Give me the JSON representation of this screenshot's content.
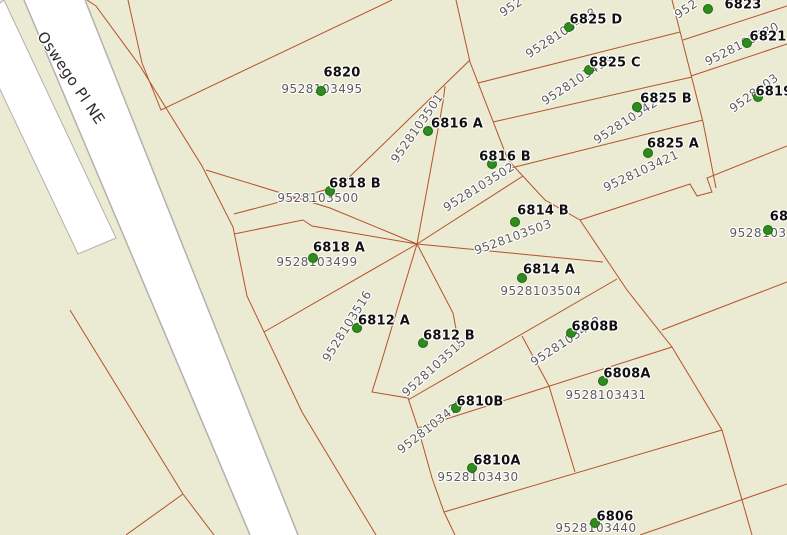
{
  "street": {
    "name": "Oswego Pl NE"
  },
  "colors": {
    "background": "#ebead3",
    "parcel_line": "#b5522b",
    "road_fill": "#ffffff",
    "road_edge": "#b3b1ad",
    "dot": "#2f8b1f",
    "dot_edge": "#1c6a0e",
    "address_text": "#111111",
    "parcel_text": "#5c5c5c",
    "street_text": "#2b2b2b"
  },
  "points": [
    {
      "address": "6820",
      "ax": 342,
      "ay": 73,
      "dx": 321,
      "dy": 91,
      "number": "9528103495",
      "nx": 322,
      "ny": 89,
      "rot": 0
    },
    {
      "address": "6816 A",
      "ax": 457,
      "ay": 124,
      "dx": 428,
      "dy": 131,
      "number": "9528103501",
      "nx": 417,
      "ny": 128,
      "rot": -55
    },
    {
      "address": "6816 B",
      "ax": 505,
      "ay": 157,
      "dx": 492,
      "dy": 164,
      "number": "9528103502",
      "nx": 479,
      "ny": 187,
      "rot": -32
    },
    {
      "address": "6814 B",
      "ax": 543,
      "ay": 211,
      "dx": 515,
      "dy": 222,
      "number": "9528103503",
      "nx": 513,
      "ny": 237,
      "rot": -20
    },
    {
      "address": "6814 A",
      "ax": 549,
      "ay": 270,
      "dx": 522,
      "dy": 278,
      "number": "9528103504",
      "nx": 541,
      "ny": 291,
      "rot": 0
    },
    {
      "address": "6818 B",
      "ax": 355,
      "ay": 184,
      "dx": 330,
      "dy": 191,
      "number": "9528103500",
      "nx": 318,
      "ny": 198,
      "rot": 0
    },
    {
      "address": "6818 A",
      "ax": 339,
      "ay": 248,
      "dx": 313,
      "dy": 258,
      "number": "9528103499",
      "nx": 317,
      "ny": 262,
      "rot": 0
    },
    {
      "address": "6812 A",
      "ax": 384,
      "ay": 321,
      "dx": 357,
      "dy": 328,
      "number": "9528103516",
      "nx": 347,
      "ny": 326,
      "rot": -58
    },
    {
      "address": "6812 B",
      "ax": 449,
      "ay": 336,
      "dx": 423,
      "dy": 343,
      "number": "9528103515",
      "nx": 434,
      "ny": 367,
      "rot": -42
    },
    {
      "address": "6810B",
      "ax": 480,
      "ay": 402,
      "dx": 456,
      "dy": 408,
      "number": "9528103429",
      "nx": 431,
      "ny": 426,
      "rot": -38
    },
    {
      "address": "6810A",
      "ax": 497,
      "ay": 461,
      "dx": 472,
      "dy": 468,
      "number": "9528103430",
      "nx": 478,
      "ny": 477,
      "rot": 0
    },
    {
      "address": "6808B",
      "ax": 595,
      "ay": 327,
      "dx": 571,
      "dy": 333,
      "number": "9528103432",
      "nx": 566,
      "ny": 341,
      "rot": -33
    },
    {
      "address": "6808A",
      "ax": 627,
      "ay": 374,
      "dx": 603,
      "dy": 381,
      "number": "9528103431",
      "nx": 606,
      "ny": 395,
      "rot": 0
    },
    {
      "address": "6806",
      "ax": 615,
      "ay": 517,
      "dx": 595,
      "dy": 523,
      "number": "9528103440",
      "nx": 596,
      "ny": 528,
      "rot": 0
    },
    {
      "address": "6825 D",
      "ax": 596,
      "ay": 20,
      "dx": 569,
      "dy": 27,
      "number": "9528103418",
      "nx": 561,
      "ny": 33,
      "rot": -33
    },
    {
      "address": "6825 C",
      "ax": 615,
      "ay": 63,
      "dx": 589,
      "dy": 70,
      "number": "9528103419",
      "nx": 577,
      "ny": 80,
      "rot": -33
    },
    {
      "address": "6825 B",
      "ax": 666,
      "ay": 99,
      "dx": 637,
      "dy": 107,
      "number": "9528103420",
      "nx": 629,
      "ny": 119,
      "rot": -33
    },
    {
      "address": "6825 A",
      "ax": 673,
      "ay": 144,
      "dx": 648,
      "dy": 153,
      "number": "9528103421",
      "nx": 641,
      "ny": 171,
      "rot": -25
    },
    {
      "address": "6823",
      "ax": 743,
      "ay": 5,
      "dx": 708,
      "dy": 9,
      "number": "952",
      "nx": 686,
      "ny": 9,
      "rot": -33
    },
    {
      "address": "6821",
      "ax": 768,
      "ay": 37,
      "dx": 747,
      "dy": 43,
      "number": "9528103530",
      "nx": 742,
      "ny": 44,
      "rot": -27
    },
    {
      "address": "6819",
      "ax": 774,
      "ay": 92,
      "dx": 758,
      "dy": 97,
      "number": "9528103",
      "nx": 754,
      "ny": 93,
      "rot": -36
    },
    {
      "address": "68",
      "ax": 779,
      "ay": 217,
      "dx": 768,
      "dy": 230,
      "number": "9528103",
      "nx": 758,
      "ny": 233,
      "rot": 0
    }
  ],
  "fragments": [
    {
      "text": "952",
      "x": 511,
      "y": 7,
      "rot": -33
    }
  ],
  "geometry": {
    "road_polygon": "24,0 85,0 298,535 250,535",
    "sliver_polygon": "-30,26 4,0 116,238 78,254",
    "road_edges_path": "M24,0 L250,535 M85,0 L298,535",
    "parcel_lines_path": "M96,6 L140,66 L202,166 L233,227 L247,296 L302,412 L376,535 M87,0 L96,6 M128,0 L142,63 M392,0 L161,110 L142,63 M470,60 L340,186 L234,214 M456,0 L470,62 L508,160 L545,200 L580,220 M580,220 L690,184 L697,196 L712,192 L707,178 L787,146 M478,83 L680,32 M493,122 L692,77 M511,168 L703,120 M672,0 L703,122 L716,188 M683,40 L787,6 M691,76 L787,44 M662,330 L787,282 M580,220 L627,290 L672,347 L722,430 L752,535 M408,400 L617,279 M418,428 L672,347 M444,512 L722,430 M640,535 L787,484 M522,336 L549,386 L575,472 M417,244 L443,102 L445,86 M417,244 L523,176 M417,244 L603,262 M417,244 L453,313 L460,350 M417,244 L400,300 L382,360 L372,392 L408,398 L418,428 L432,478 L444,512 L455,535 M417,244 L264,332 M417,244 L312,226 L303,220 L234,234 M417,244 L330,208 L206,170 M70,310 L183,494 L214,535 M183,494 L126,535"
  }
}
